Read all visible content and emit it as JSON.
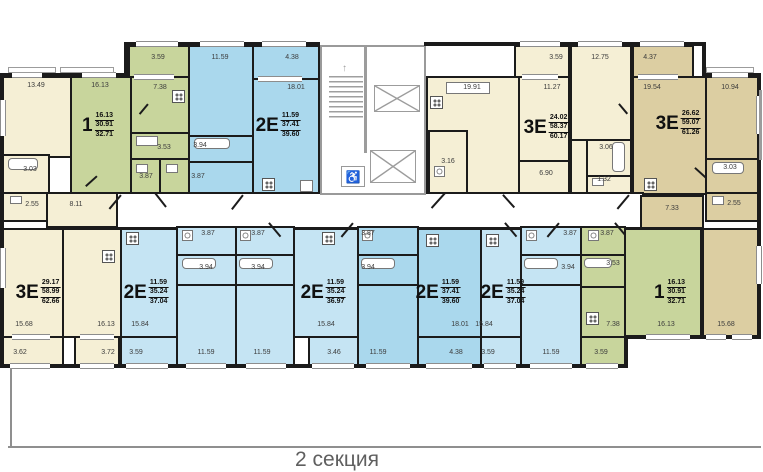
{
  "section_label": "2 секция",
  "icons": {
    "accessible": "♿",
    "stair_arrow": "↑"
  },
  "colors": {
    "cream": "#f5efd5",
    "tan": "#dccea2",
    "green": "#c8d59c",
    "blue_light": "#c5e4f3",
    "blue_medium": "#aad8ed",
    "wall": "#1b1b1b"
  },
  "apartments": {
    "top_green": {
      "type": "1",
      "areas": [
        "16.13",
        "30.91",
        "32.71"
      ]
    },
    "top_blue": {
      "type": "2Е",
      "areas": [
        "11.59",
        "37.41",
        "39.60"
      ]
    },
    "top_cream": {
      "type": "3Е",
      "areas": [
        "24.02",
        "58.37",
        "60.17"
      ]
    },
    "top_tan": {
      "type": "3Е",
      "areas": [
        "26.62",
        "59.07",
        "61.26"
      ]
    },
    "bottom_cream": {
      "type": "3Е",
      "areas": [
        "29.17",
        "58.99",
        "62.66"
      ]
    },
    "bottom_blue1": {
      "type": "2Е",
      "areas": [
        "11.59",
        "35.24",
        "37.04"
      ]
    },
    "bottom_blue2": {
      "type": "2Е",
      "areas": [
        "11.59",
        "35.24",
        "36.97"
      ]
    },
    "bottom_blue3": {
      "type": "2Е",
      "areas": [
        "11.59",
        "37.41",
        "39.60"
      ]
    },
    "bottom_blue4": {
      "type": "2Е",
      "areas": [
        "11.59",
        "35.24",
        "37.04"
      ]
    },
    "bottom_green": {
      "type": "1",
      "areas": [
        "16.13",
        "30.91",
        "32.71"
      ]
    }
  },
  "room_dims": [
    "13.49",
    "16.13",
    "7.38",
    "3.59",
    "11.59",
    "4.38",
    "18.01",
    "3.53",
    "3.94",
    "3.87",
    "3.87",
    "3.03",
    "2.55",
    "8.11",
    "19.91",
    "3.59",
    "11.27",
    "3.16",
    "6.90",
    "12.75",
    "4.37",
    "19.54",
    "10.94",
    "3.06",
    "1.32",
    "3.03",
    "2.55",
    "7.33",
    "15.68",
    "16.13",
    "3.62",
    "3.72",
    "3.59",
    "15.84",
    "3.87",
    "3.94",
    "11.59",
    "3.87",
    "3.94",
    "11.59",
    "15.84",
    "3.46",
    "3.87",
    "3.94",
    "11.59",
    "18.01",
    "4.38",
    "15.84",
    "3.59",
    "11.59",
    "3.87",
    "3.94",
    "3.87",
    "3.53",
    "7.38",
    "3.59",
    "16.13",
    "15.68"
  ]
}
